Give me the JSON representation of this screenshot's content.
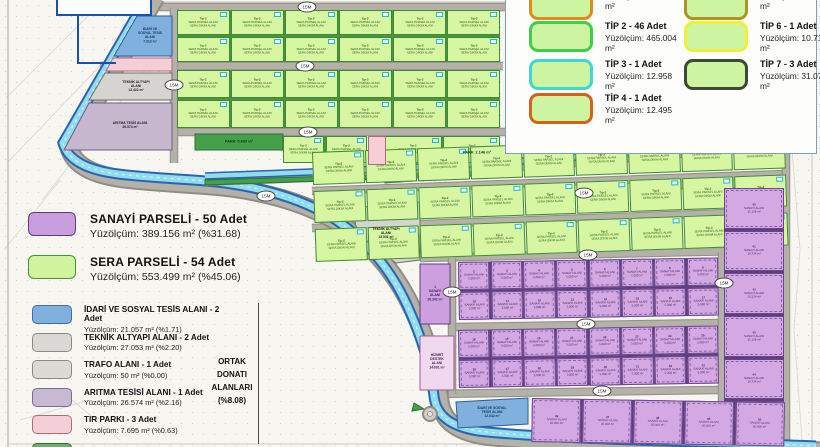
{
  "legend_left": {
    "main": [
      {
        "name": "SANAYİ PARSELİ - 50 Adet",
        "area": "Yüzölçüm: 389.156 m² (%31.68)",
        "color": "#c79ddd",
        "border": "#5f3d7d"
      },
      {
        "name": "SERA PARSELİ - 54 Adet",
        "area": "Yüzölçüm: 553.499 m² (%45.06)",
        "color": "#d0f49c",
        "border": "#4a8f3c"
      }
    ],
    "common": [
      {
        "name": "İDARİ VE SOSYAL TESİS ALANI - 2 Adet",
        "area": "Yüzölçüm: 21.057 m² (%1.71)",
        "color": "#7fb0de",
        "border": "#3c6ea8"
      },
      {
        "name": "TEKNİK ALTYAPI ALANI - 2 Adet",
        "area": "Yüzölçüm: 27.053 m² (%2.20)",
        "color": "#d9d8d4",
        "border": "#8a8983"
      },
      {
        "name": "TRAFO ALANI - 1 Adet",
        "area": "Yüzölçüm: 50 m² (%0.00)",
        "color": "#dbdad6",
        "border": "#8a8983"
      },
      {
        "name": "ARITMA TESİSİ ALANI - 1 Adet",
        "area": "Yüzölçüm: 26.574 m² (%2.16)",
        "color": "#c8b9d2",
        "border": "#7c6b90"
      },
      {
        "name": "TIR PARKI - 3 Adet",
        "area": "Yüzölçüm: 7.695 m² (%0.63)",
        "color": "#f4cfd7",
        "border": "#b06a78"
      },
      {
        "name": "",
        "area": "",
        "color": "#6fae6f",
        "border": "#2f6d2f"
      }
    ],
    "ortak_lines": [
      "ORTAK",
      "DONATI",
      "ALANLARI",
      "(%8.08)"
    ]
  },
  "legend_right": {
    "col1": [
      {
        "title": "",
        "area": "Yüzölçüm: 10.180 m²",
        "border": "#e08a1a"
      },
      {
        "title": "TİP 2 - 46 Adet",
        "area": "Yüzölçüm: 465.004 m²",
        "border": "#3ecf4a"
      },
      {
        "title": "TİP 3 - 1 Adet",
        "area": "Yüzölçüm: 12.958 m²",
        "border": "#3fd6d6"
      },
      {
        "title": "TİP 4 - 1 Adet",
        "area": "Yüzölçüm: 12.495 m²",
        "border": "#d95f17"
      }
    ],
    "col2": [
      {
        "title": "",
        "area": "Yüzölçüm: 11.065 m²",
        "border": "#b09226"
      },
      {
        "title": "TİP 6 - 1 Adet",
        "area": "Yüzölçüm: 10.711 m²",
        "border": "#f0ef3a"
      },
      {
        "title": "TİP 7 - 3 Adet",
        "area": "Yüzölçüm: 31.077 m²",
        "border": "#3c4a34"
      }
    ]
  },
  "map": {
    "road_badge": "15M",
    "facilities": {
      "idari_top": {
        "name": "İDARİ VE SOSYAL TESİS ALANI",
        "area": "7.013 m²"
      },
      "teknik_left": {
        "name": "TEKNİK ALTYAPI ALANI",
        "area": "13.422 m²"
      },
      "aritma": {
        "name": "ARITMA TESİS ALANI",
        "area": "26.574 m²"
      },
      "teknik_mid": {
        "name": "TEKNİK ALTYAPI ALANI",
        "area": "13.531 m²"
      },
      "idari_bottom": {
        "name": "İDARİ VE SOSYAL TESİS ALANI",
        "area": "12.042 m²"
      },
      "hizmet": {
        "name": "HİZMET DESTEK ALANI",
        "area": "14.691 m²"
      },
      "sanayi_1": {
        "num": "1",
        "name": "SANAYİ ALANI",
        "area": "26.342 m²"
      },
      "park_1": {
        "name": "PARK",
        "area": "5.683 m²"
      },
      "park_2": {
        "name": "PARK",
        "area": "2.146 m²"
      }
    },
    "sera_cell_lines": [
      "Tip-2",
      "SERA PARSEL ALANI",
      "SERA DİKİM ALANI"
    ],
    "sanayi_cell": {
      "name": "SANAYİ ALANI",
      "small_area": "5.000 m²",
      "bottom_area": "20.000 m²",
      "right_areas": [
        "11.128 m²",
        "10.724 m²",
        "10.224 m²"
      ]
    }
  },
  "colors": {
    "sanayi": "#c79ddd",
    "sera": "#d0f49c",
    "idari": "#7fb0de",
    "teknik": "#d9d8d4",
    "aritma": "#c8b9d2",
    "tir": "#f4cfd7",
    "park": "#44a049",
    "canal": "#90dcec",
    "canal_edge": "#2a64b0",
    "road": "#b3b1a8"
  }
}
